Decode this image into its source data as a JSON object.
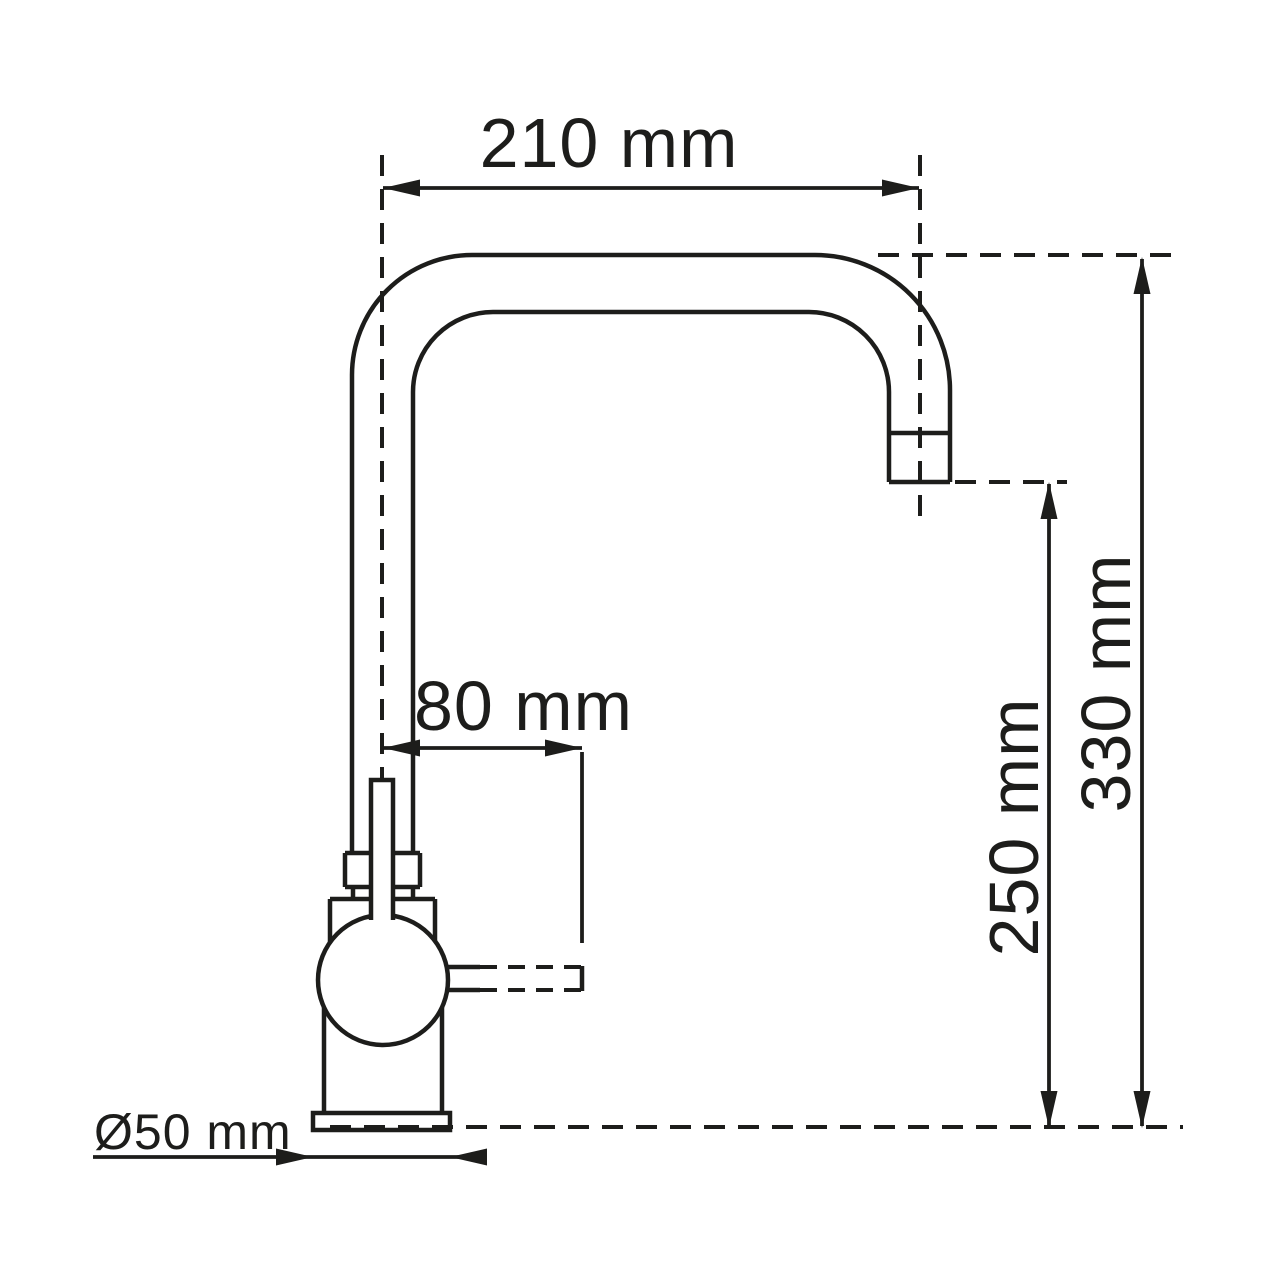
{
  "drawing": {
    "kind": "technical-dimension-drawing",
    "subject": "kitchen mixer tap side profile",
    "colors": {
      "line": "#1d1d1b",
      "background": "#ffffff"
    },
    "dimensions": {
      "spout_reach": "210 mm",
      "handle_reach": "80 mm",
      "outlet_height": "250 mm",
      "overall_height": "330 mm",
      "base_diameter": "Ø50 mm"
    }
  }
}
